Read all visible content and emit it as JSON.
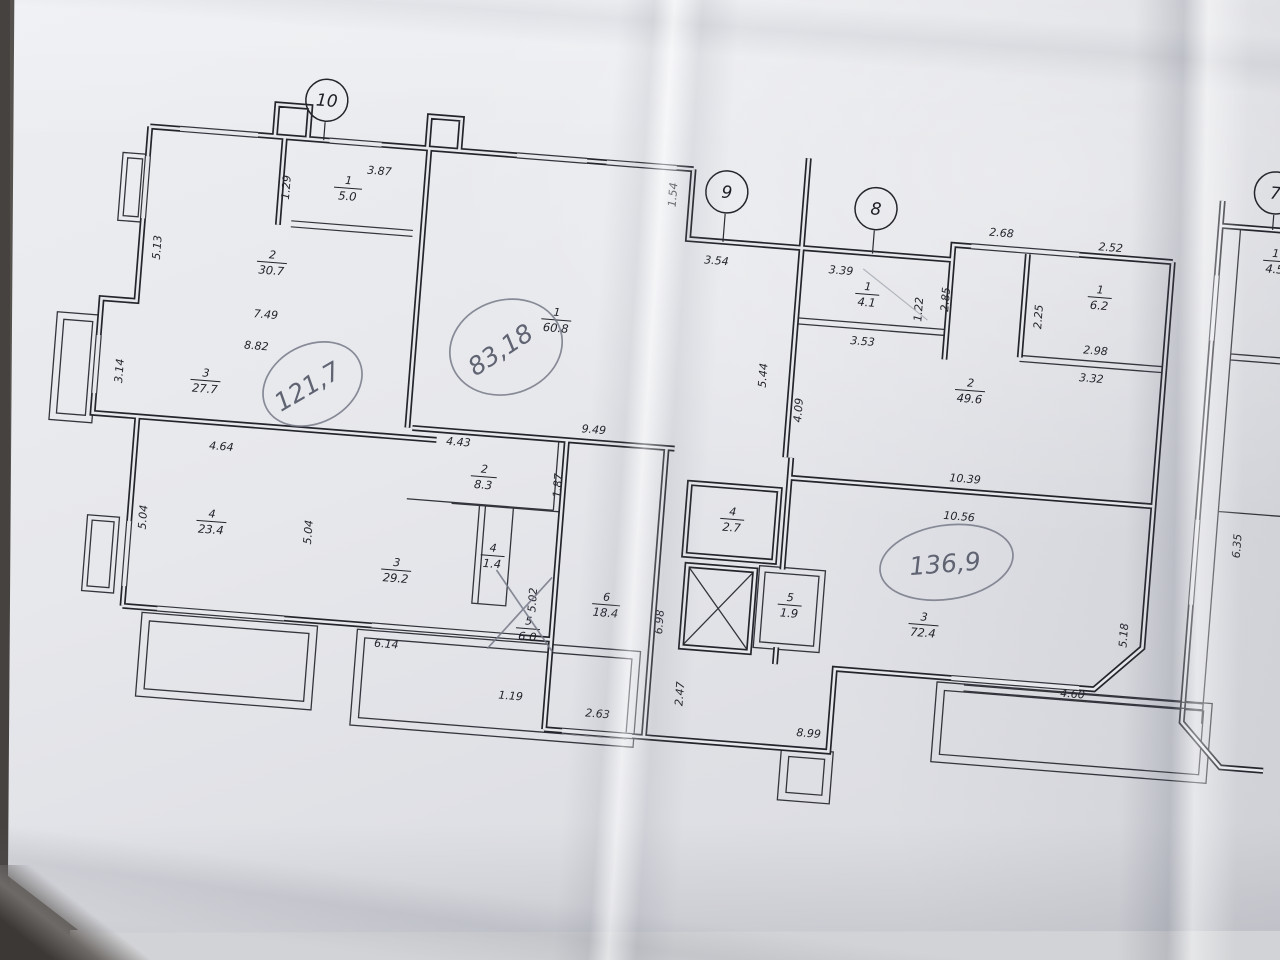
{
  "plan": {
    "unit_markers": {
      "m10": "10",
      "m9": "9",
      "m8": "8",
      "m7": "7"
    },
    "handwritten_totals": {
      "apt10": "121,7",
      "apt9": "83,18",
      "apt8": "136,9"
    },
    "rooms": {
      "a10_r1": {
        "num": "1",
        "area": "5.0"
      },
      "a10_r2": {
        "num": "2",
        "area": "30.7"
      },
      "a10_r3": {
        "num": "3",
        "area": "27.7"
      },
      "a10_r4": {
        "num": "4",
        "area": "23.4"
      },
      "a10_r3b": {
        "num": "3",
        "area": "29.2"
      },
      "a9_r1": {
        "num": "1",
        "area": "60.8"
      },
      "a9_r2": {
        "num": "2",
        "area": "8.3"
      },
      "a9_r4": {
        "num": "4",
        "area": "1.4"
      },
      "a9_r5": {
        "num": "5",
        "area": "6.0"
      },
      "a9_r6": {
        "num": "6",
        "area": "18.4"
      },
      "a8_r1": {
        "num": "1",
        "area": "4.1"
      },
      "a8_r1b": {
        "num": "1",
        "area": "6.2"
      },
      "a8_r2": {
        "num": "2",
        "area": "49.6"
      },
      "a8_r3": {
        "num": "3",
        "area": "72.4"
      },
      "a8_r4": {
        "num": "4",
        "area": "2.7"
      },
      "a8_r5": {
        "num": "5",
        "area": "1.9"
      },
      "a7_r1": {
        "num": "1",
        "area": "4.5"
      }
    },
    "dims": {
      "d129": "1.29",
      "d387": "3.87",
      "d513": "5.13",
      "d749": "7.49",
      "d882": "8.82",
      "d314": "3.14",
      "d464": "4.64",
      "d504a": "5.04",
      "d504b": "5.04",
      "d614": "6.14",
      "d119": "1.19",
      "d443": "4.43",
      "d187": "1.87",
      "d949": "9.49",
      "d502": "5.02",
      "d263": "2.63",
      "d698": "6.98",
      "d247": "2.47",
      "d154": "1.54",
      "d354": "3.54",
      "d339": "3.39",
      "d353": "3.53",
      "d122": "1.22",
      "d544": "5.44",
      "d409": "4.09",
      "d285": "2.85",
      "d268": "2.68",
      "d252": "2.52",
      "d225": "2.25",
      "d298": "2.98",
      "d332": "3.32",
      "d1039": "10.39",
      "d1056": "10.56",
      "d899": "8.99",
      "d460": "4.60",
      "d518": "5.18",
      "d635": "6.35"
    }
  }
}
